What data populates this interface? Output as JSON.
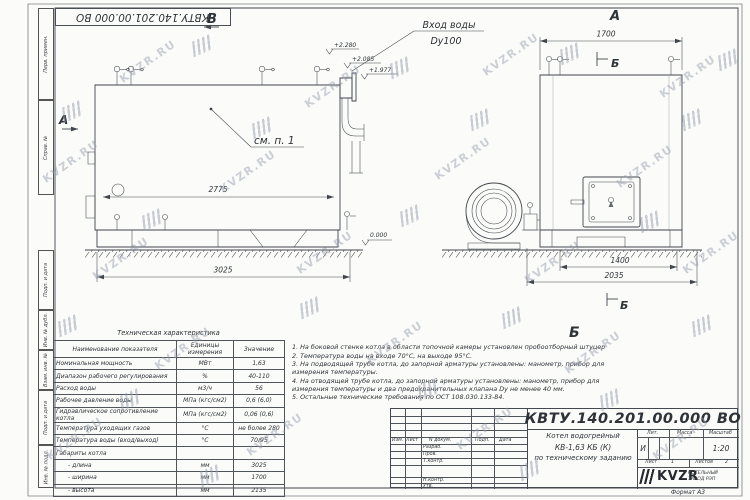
{
  "sheet": {
    "doc_number": "КВТУ.140.201.00.000  ВО",
    "watermark": "KVZR.RU"
  },
  "frame": {
    "strips": [
      "Перв. примен.",
      "Справ. №",
      "Подп. и дата",
      "Инв. № дубл.",
      "Взам. инв. №",
      "Подп. и дата",
      "Инв. № подл."
    ]
  },
  "drawing": {
    "view_b": "В",
    "view_a_left": "А",
    "view_a_right": "А",
    "section_b_top": "Б",
    "section_b_bottom": "Б",
    "view_b_big": "Б",
    "inlet_line1": "Вход воды",
    "inlet_line2": "Dy100",
    "see_item": "см. п. 1",
    "levels": {
      "l2280": "+2.280",
      "l2085": "+2.085",
      "l1977": "+1.977",
      "zero": "0.000"
    },
    "dims": {
      "d2775": "2775",
      "d3025": "3025",
      "d1700": "1700",
      "d1400": "1400",
      "d2035": "2035"
    }
  },
  "table": {
    "title": "Техническая характеристика",
    "headers": [
      "Наименование показателя",
      "Единицы измерения",
      "Значение"
    ],
    "rows": [
      {
        "name": "Номинальная мощность",
        "units": "МВт",
        "value": "1,63"
      },
      {
        "name": "Диапазон рабочего регулирования",
        "units": "%",
        "value": "40-110"
      },
      {
        "name": "Расход воды",
        "units": "м3/ч",
        "value": "56"
      },
      {
        "name": "Рабочее давление воды",
        "units": "МПа (кгс/см2)",
        "value": "0,6 (6,0)"
      },
      {
        "name": "Гидравлическое сопротивление котла",
        "units": "МПа (кгс/см2)",
        "value": "0,06 (0,6)"
      },
      {
        "name": "Температура уходящих газов",
        "units": "°С",
        "value": "не более 280"
      },
      {
        "name": "Температура воды (вход/выход)",
        "units": "°С",
        "value": "70/95"
      },
      {
        "name": "Габариты котла",
        "units": "",
        "value": ""
      },
      {
        "name": "- длина",
        "units": "мм",
        "value": "3025"
      },
      {
        "name": "- ширина",
        "units": "мм",
        "value": "1700"
      },
      {
        "name": "- высота",
        "units": "мм",
        "value": "2135"
      }
    ]
  },
  "notes": {
    "items": [
      "1.  На боковой стенке котла в области топочной камеры установлен пробоотборный штуцер",
      "2.  Температура воды на входе  70°С, на выходе  95°С.",
      "3.  На подводящей трубе котла, до запорной арматуры установлены: манометр, прибор для измерения температуры.",
      "4.  На отводящей трубе котла, до запорной арматуры установлены: манометр, прибор для измерения температуры и два предохранительных клапана  Dу не менее  40 мм.",
      "5.  Остальные технические требования по ОСТ  108.030.133-84."
    ]
  },
  "titleblock": {
    "doc_number": "КВТУ.140.201.00.000  ВО",
    "col_izm": "Изм.",
    "col_list": "Лист",
    "col_ndoc": "N докум.",
    "col_podp": "Подп.",
    "col_data": "Дата",
    "row_razrab": "Разраб.",
    "row_prov": "Пров.",
    "row_tkontr": "Т.контр.",
    "row_nkontr": "Н.контр.",
    "row_utv": "Утв.",
    "title_line1": "Котел водогрейный",
    "title_line2": "КВ-1,63 КБ (К)",
    "title_line3": "по техническому заданию",
    "lit_header": "Лит.",
    "mass_header": "Масса",
    "scale_header": "Масштаб",
    "lit_value": "И",
    "scale_value": "1:20",
    "sheet_label": "Лист",
    "sheet_value": "1",
    "sheets_label": "Листов",
    "sheets_value": "2",
    "logo": "KVZR",
    "company_line1": "КОТЕЛЬНЫЙ",
    "company_line2": "ЗАВОД РЭП",
    "format": "Формат  А3"
  }
}
